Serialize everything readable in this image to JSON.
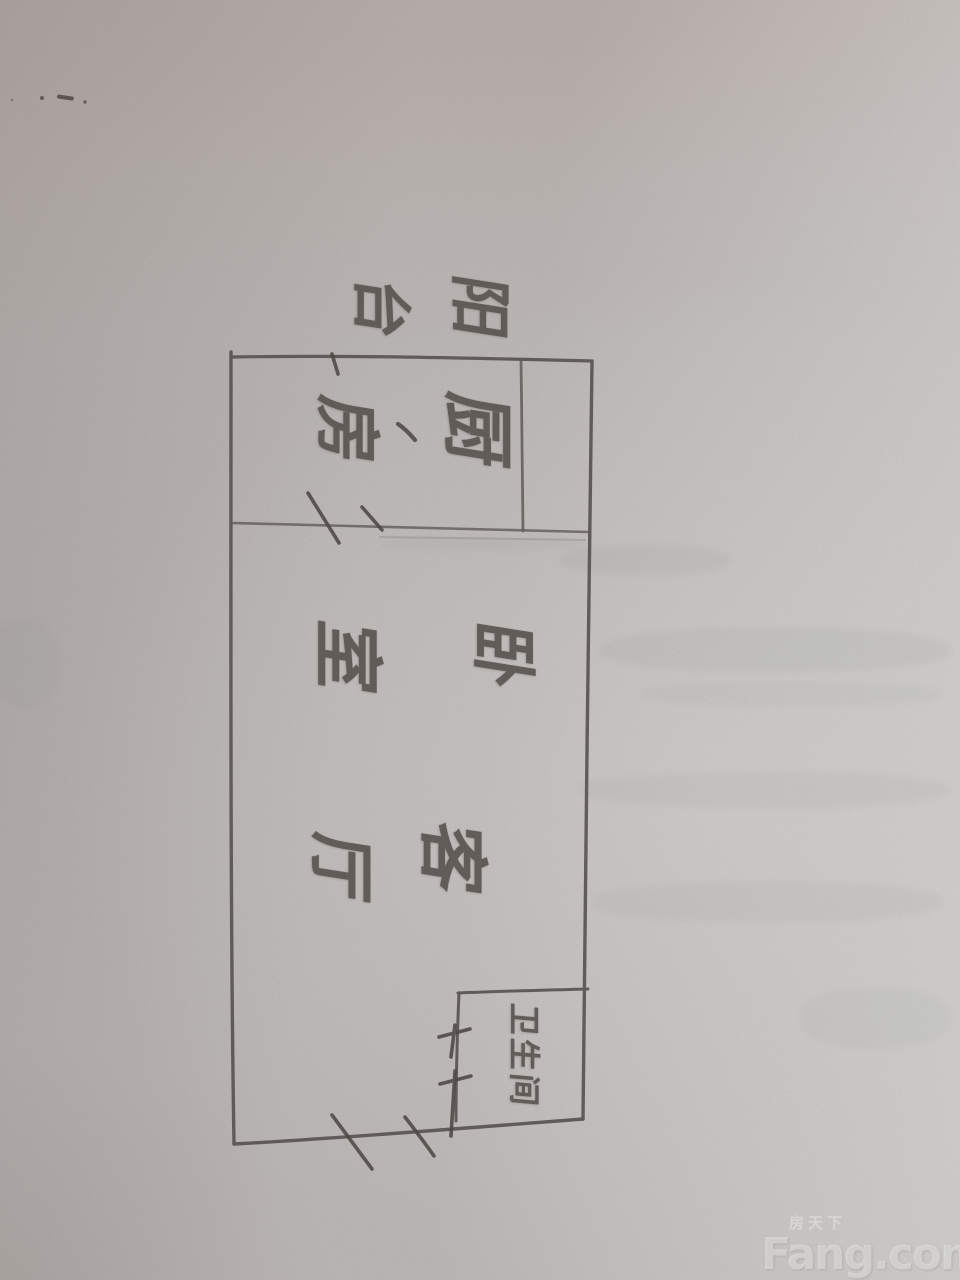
{
  "scene": {
    "description": "Photograph of a hand-drawn apartment floor plan sketched in pencil on paper",
    "width_px": 960,
    "height_px": 1280
  },
  "floorplan": {
    "rooms": [
      {
        "id": "balcony",
        "label": "阳台",
        "chars": [
          "阳",
          "台"
        ]
      },
      {
        "id": "kitchen",
        "label": "厨房",
        "chars": [
          "厨",
          "房"
        ],
        "punct": "、"
      },
      {
        "id": "bedroom",
        "label": "卧室",
        "chars": [
          "卧",
          "室"
        ]
      },
      {
        "id": "living-room",
        "label": "客厅",
        "chars": [
          "客",
          "厅"
        ]
      },
      {
        "id": "bathroom",
        "label": "卫生间"
      }
    ],
    "text_orientation": "rotated 90 degrees clockwise (photo taken sideways)"
  },
  "watermark": {
    "brand_cn": "房天下",
    "brand_en": "Fang.com"
  },
  "colors": {
    "paper": "#c2bdba",
    "pencil": "#4a433e",
    "watermark_text": "rgba(255,255,255,0.55)"
  }
}
